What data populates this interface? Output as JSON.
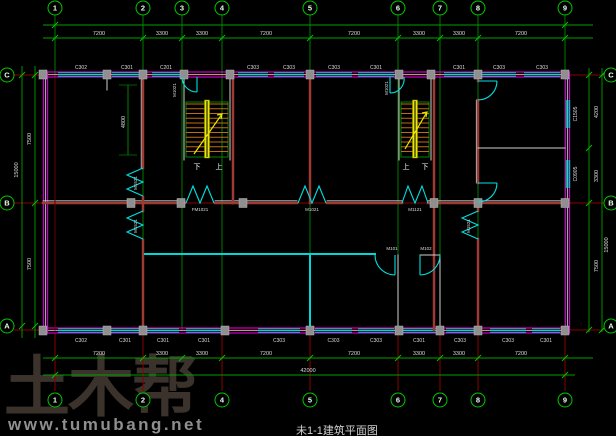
{
  "title": "未1-1建筑平面图",
  "watermark": {
    "logo": "土木帮",
    "url": "www.tumubang.net"
  },
  "axes": {
    "top": [
      "1",
      "2",
      "3",
      "4",
      "5",
      "6",
      "7",
      "8",
      "9"
    ],
    "bottom": [
      "1",
      "2",
      "4",
      "5",
      "6",
      "7",
      "8",
      "9"
    ],
    "left": [
      "C",
      "B",
      "A"
    ],
    "right": [
      "C",
      "B",
      "A"
    ]
  },
  "dimensions": {
    "top_segments": [
      "7200",
      "3300",
      "3300",
      "7200",
      "7200",
      "3300",
      "3300",
      "7200"
    ],
    "bottom_segments": [
      "7200",
      "3300",
      "3300",
      "7200",
      "7200",
      "3300",
      "3300",
      "7200"
    ],
    "bottom_total": "42000",
    "left_segments": [
      "7500",
      "7500"
    ],
    "left_total": "15000",
    "right_segments": [
      "4200",
      "3300",
      "7500"
    ],
    "right_total": "15000",
    "room_depth": "4800"
  },
  "window_labels": {
    "top": [
      "C302",
      "C301",
      "C201",
      "C303",
      "C303",
      "C303",
      "C301",
      "C301",
      "C303",
      "C303"
    ],
    "bottom": [
      "C302",
      "C301",
      "C301",
      "C301",
      "C303",
      "C303",
      "C303",
      "C301",
      "C303",
      "C303",
      "C301"
    ],
    "right": [
      "C1505",
      "C0905"
    ]
  },
  "door_labels": {
    "corridor": [
      "FM1021",
      "M1021",
      "M1121"
    ],
    "corridor_end": [
      "M101",
      "M102"
    ],
    "side_double": [
      "M1521",
      "M1521",
      "M1521"
    ],
    "stair_entry": [
      "M1021",
      "M1021"
    ]
  },
  "stairs": {
    "up": "上",
    "down": "下"
  },
  "colors": {
    "background": "#000000",
    "grid_green": "#007a00",
    "dim_green": "#00a000",
    "tick_green": "#00c000",
    "bubble_green": "#00c800",
    "wall_magenta": "#c400c4",
    "window_cyan": "#00d8d8",
    "interior_wall_red": "#9c3a34",
    "axis_red": "#8a0000",
    "column_gray": "#8f8f8f",
    "stair_yellow": "#e8e800",
    "stair_tread_orange": "#c46a10",
    "text_white": "#dcdcdc",
    "watermark_dark": "#3a322b",
    "watermark_url_gray": "#8f8f8f"
  }
}
